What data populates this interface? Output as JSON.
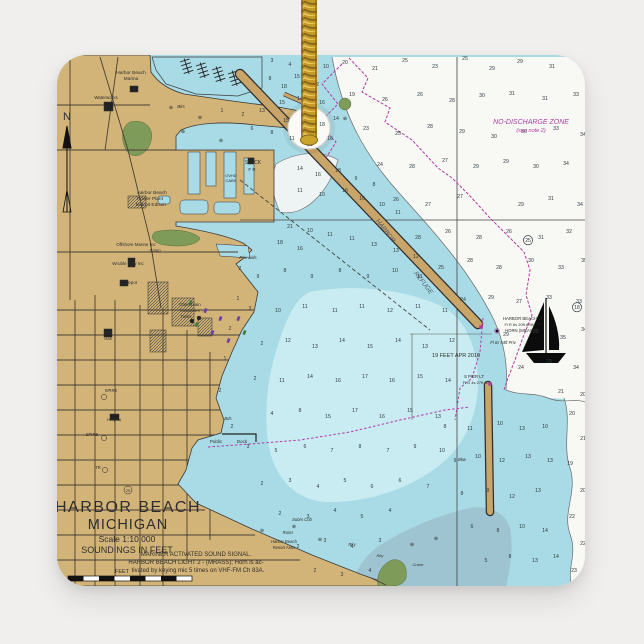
{
  "product": {
    "type": "square ceramic holiday ornament with gold hanging cord",
    "background_color": "#f0efed",
    "cord": {
      "gold_mid": "#c79a2a",
      "gold_light": "#e9c95c",
      "gold_dark": "#8a6a1a"
    }
  },
  "palette": {
    "bg": "#f0efed",
    "land": "#d3b478",
    "water": "#a9dbe6",
    "water_light": "#c9ecf2",
    "water_deep": "#f8f8f4",
    "water_gray": "#9cc0cc",
    "green": "#7e9b5a",
    "breakwater": "#c9a569",
    "magenta": "#b13ba5",
    "ink": "#2e2e2e",
    "street": "#473f33"
  },
  "chart": {
    "title": "HARBOR BEACH MICHIGAN nautical chart",
    "labels": [
      {
        "t": "HARBOR  BEACH",
        "x": 128,
        "y": 512,
        "s": 16,
        "ls": 1.5
      },
      {
        "t": "MICHIGAN",
        "x": 128,
        "y": 529,
        "s": 14.5,
        "ls": 1
      },
      {
        "t": "Scale 1:10,000",
        "x": 127,
        "y": 542,
        "s": 8.5
      },
      {
        "t": "SOUNDINGS IN FEET",
        "x": 127,
        "y": 553,
        "s": 9
      },
      {
        "t": "MARINER ACTIVATED SOUND SIGNAL.",
        "x": 196,
        "y": 556,
        "s": 6
      },
      {
        "t": "HARBOR BEACH LIGHT 2 - (MRASS); Horn is ac-",
        "x": 196,
        "y": 564,
        "s": 6
      },
      {
        "t": "tivated by keying mic 5 times on VHF-FM Ch 83A.",
        "x": 198,
        "y": 572,
        "s": 6
      },
      {
        "t": "FEET",
        "x": 122,
        "y": 573,
        "s": 5.5
      },
      {
        "t": "N",
        "x": 67,
        "y": 120,
        "s": 11
      },
      {
        "t": "Harbor Beach",
        "x": 131,
        "y": 74,
        "s": 4.8
      },
      {
        "t": "Marina",
        "x": 131,
        "y": 80,
        "s": 4.8
      },
      {
        "t": "Waterworks",
        "x": 106,
        "y": 99,
        "s": 4.5
      },
      {
        "t": "Bks",
        "x": 181,
        "y": 108,
        "s": 4.5,
        "i": true
      },
      {
        "t": "Harbor Beach",
        "x": 152,
        "y": 194,
        "s": 4.8
      },
      {
        "t": "Power Plant",
        "x": 150,
        "y": 200,
        "s": 4.8
      },
      {
        "t": "Detroit Edison",
        "x": 151,
        "y": 206,
        "s": 4.8
      },
      {
        "t": "Offshore Marine Inc",
        "x": 136,
        "y": 246,
        "s": 4.5
      },
      {
        "t": "Ramp",
        "x": 155,
        "y": 252,
        "s": 4.2,
        "i": true
      },
      {
        "t": "Wruble Elev Inc",
        "x": 128,
        "y": 265,
        "s": 4.5
      },
      {
        "t": "Depot",
        "x": 131,
        "y": 284,
        "s": 4.5
      },
      {
        "t": "Champlain",
        "x": 190,
        "y": 306,
        "s": 4.5
      },
      {
        "t": "Industries",
        "x": 190,
        "y": 312,
        "s": 4.5
      },
      {
        "t": "Tanks",
        "x": 186,
        "y": 318,
        "s": 4.2
      },
      {
        "t": "City",
        "x": 108,
        "y": 334,
        "s": 4.2
      },
      {
        "t": "Hall",
        "x": 108,
        "y": 340,
        "s": 4.2
      },
      {
        "t": "Hospital",
        "x": 114,
        "y": 421,
        "s": 4
      },
      {
        "t": "SPIRE",
        "x": 111,
        "y": 392,
        "s": 4.2
      },
      {
        "t": "SPIRE",
        "x": 92,
        "y": 436,
        "s": 4.2
      },
      {
        "t": "TR",
        "x": 98,
        "y": 469,
        "s": 4.2
      },
      {
        "t": "25",
        "x": 128,
        "y": 492,
        "s": 4
      },
      {
        "t": "STACK",
        "x": 253,
        "y": 164,
        "s": 5
      },
      {
        "t": "F R",
        "x": 252,
        "y": 171,
        "s": 4.5
      },
      {
        "t": "OVHD",
        "x": 231,
        "y": 177,
        "s": 4
      },
      {
        "t": "CABS",
        "x": 231,
        "y": 182,
        "s": 4
      },
      {
        "t": "Priv aids",
        "x": 248,
        "y": 259,
        "s": 4.5,
        "i": true
      },
      {
        "t": "Public",
        "x": 216,
        "y": 443,
        "s": 4.5
      },
      {
        "t": "Dock",
        "x": 242,
        "y": 443,
        "s": 4.5
      },
      {
        "t": "Bds",
        "x": 228,
        "y": 420,
        "s": 4.2,
        "i": true
      },
      {
        "t": "Bkw",
        "x": 462,
        "y": 461,
        "s": 4.2,
        "i": true
      },
      {
        "t": "HARBOR",
        "x": 384,
        "y": 232,
        "s": 6.5,
        "r": 52,
        "i": true,
        "c": "#4a5a66"
      },
      {
        "t": "REFUGE",
        "x": 422,
        "y": 284,
        "s": 6.5,
        "r": 52,
        "i": true,
        "c": "#4a5a66"
      },
      {
        "t": "NO-DISCHARGE ZONE",
        "x": 531,
        "y": 124,
        "s": 7,
        "i": true,
        "c": "#b13ba5"
      },
      {
        "t": "(see note 2)",
        "x": 531,
        "y": 132,
        "s": 5.5,
        "i": true,
        "c": "#b13ba5"
      },
      {
        "t": "19 FEET APR 2016",
        "x": 456,
        "y": 357,
        "s": 5.5
      },
      {
        "t": "HARBOR BEACH LT",
        "x": 523,
        "y": 320,
        "s": 4.3
      },
      {
        "t": "Fl R 6s 20ft 8StM \"2\"",
        "x": 523,
        "y": 326,
        "s": 4
      },
      {
        "t": "HORN (MRASS)",
        "x": 521,
        "y": 332,
        "s": 4.3
      },
      {
        "t": "Fl 6s 54ft Priv",
        "x": 503,
        "y": 344,
        "s": 4.2,
        "i": true
      },
      {
        "t": "S PIER LT",
        "x": 474,
        "y": 378,
        "s": 4.3
      },
      {
        "t": "Fl G 4s 27ft \"1\"",
        "x": 476,
        "y": 384,
        "s": 4
      },
      {
        "t": "Harbor Beach",
        "x": 284,
        "y": 543,
        "s": 4.2
      },
      {
        "t": "Resort Assn",
        "x": 284,
        "y": 549,
        "s": 4.2
      },
      {
        "t": "Subm Crib",
        "x": 302,
        "y": 521,
        "s": 4.2,
        "i": true
      },
      {
        "t": "Ruins",
        "x": 288,
        "y": 534,
        "s": 4.2,
        "i": true
      },
      {
        "t": "Rky",
        "x": 352,
        "y": 546,
        "s": 4.2,
        "i": true
      },
      {
        "t": "Rky",
        "x": 380,
        "y": 557,
        "s": 4,
        "i": true
      },
      {
        "t": "Crane",
        "x": 418,
        "y": 566,
        "s": 4,
        "i": true
      }
    ],
    "soundings": [
      [
        345,
        64,
        "20"
      ],
      [
        375,
        70,
        "21"
      ],
      [
        405,
        62,
        "25"
      ],
      [
        435,
        68,
        "23"
      ],
      [
        465,
        60,
        "25"
      ],
      [
        492,
        70,
        "29"
      ],
      [
        520,
        63,
        "29"
      ],
      [
        552,
        68,
        "31"
      ],
      [
        580,
        62,
        "30"
      ],
      [
        352,
        96,
        "19"
      ],
      [
        385,
        101,
        "26"
      ],
      [
        420,
        96,
        "26"
      ],
      [
        452,
        102,
        "28"
      ],
      [
        482,
        97,
        "30"
      ],
      [
        512,
        95,
        "31"
      ],
      [
        545,
        100,
        "31"
      ],
      [
        576,
        96,
        "33"
      ],
      [
        366,
        130,
        "23"
      ],
      [
        398,
        135,
        "25"
      ],
      [
        430,
        128,
        "28"
      ],
      [
        462,
        133,
        "29"
      ],
      [
        494,
        138,
        "30"
      ],
      [
        524,
        133,
        "30"
      ],
      [
        556,
        130,
        "33"
      ],
      [
        583,
        136,
        "34"
      ],
      [
        380,
        166,
        "24"
      ],
      [
        412,
        168,
        "28"
      ],
      [
        445,
        162,
        "27"
      ],
      [
        476,
        168,
        "29"
      ],
      [
        506,
        163,
        "29"
      ],
      [
        536,
        168,
        "30"
      ],
      [
        566,
        165,
        "34"
      ],
      [
        396,
        201,
        "26"
      ],
      [
        428,
        206,
        "27"
      ],
      [
        460,
        198,
        "27"
      ],
      [
        521,
        206,
        "29"
      ],
      [
        551,
        200,
        "31"
      ],
      [
        580,
        206,
        "34"
      ],
      [
        418,
        239,
        "28"
      ],
      [
        448,
        233,
        "26"
      ],
      [
        479,
        239,
        "28"
      ],
      [
        509,
        233,
        "26"
      ],
      [
        541,
        239,
        "31"
      ],
      [
        569,
        233,
        "32"
      ],
      [
        441,
        269,
        "25"
      ],
      [
        470,
        262,
        "28"
      ],
      [
        499,
        269,
        "28"
      ],
      [
        531,
        262,
        "30"
      ],
      [
        561,
        269,
        "33"
      ],
      [
        584,
        262,
        "35"
      ],
      [
        463,
        301,
        "24"
      ],
      [
        491,
        299,
        "29"
      ],
      [
        519,
        303,
        "27"
      ],
      [
        549,
        299,
        "33"
      ],
      [
        579,
        303,
        "33"
      ],
      [
        506,
        336,
        "29"
      ],
      [
        536,
        333,
        "29"
      ],
      [
        563,
        339,
        "35"
      ],
      [
        584,
        331,
        "34"
      ],
      [
        521,
        369,
        "24"
      ],
      [
        549,
        363,
        "29"
      ],
      [
        576,
        369,
        "34"
      ],
      [
        561,
        393,
        "21"
      ],
      [
        583,
        396,
        "20"
      ],
      [
        272,
        62,
        "3"
      ],
      [
        290,
        66,
        "4"
      ],
      [
        310,
        60,
        "9"
      ],
      [
        326,
        68,
        "10"
      ],
      [
        297,
        78,
        "15"
      ],
      [
        316,
        86,
        "12"
      ],
      [
        284,
        88,
        "18"
      ],
      [
        270,
        80,
        "8"
      ],
      [
        282,
        104,
        "15"
      ],
      [
        300,
        100,
        "14"
      ],
      [
        322,
        104,
        "16"
      ],
      [
        262,
        112,
        "13"
      ],
      [
        243,
        116,
        "2"
      ],
      [
        222,
        112,
        "1"
      ],
      [
        286,
        122,
        "15"
      ],
      [
        305,
        118,
        "15"
      ],
      [
        322,
        126,
        "18"
      ],
      [
        336,
        120,
        "14"
      ],
      [
        330,
        140,
        "16"
      ],
      [
        310,
        146,
        "21"
      ],
      [
        292,
        140,
        "11"
      ],
      [
        272,
        134,
        "8"
      ],
      [
        252,
        130,
        "6"
      ],
      [
        300,
        170,
        "14"
      ],
      [
        318,
        176,
        "16"
      ],
      [
        338,
        172,
        "18"
      ],
      [
        356,
        180,
        "9"
      ],
      [
        374,
        186,
        "8"
      ],
      [
        345,
        192,
        "16"
      ],
      [
        322,
        196,
        "10"
      ],
      [
        300,
        192,
        "11"
      ],
      [
        362,
        200,
        "16"
      ],
      [
        382,
        206,
        "10"
      ],
      [
        398,
        214,
        "11"
      ],
      [
        290,
        228,
        "21"
      ],
      [
        310,
        232,
        "10"
      ],
      [
        330,
        236,
        "11"
      ],
      [
        352,
        240,
        "11"
      ],
      [
        374,
        246,
        "13"
      ],
      [
        396,
        252,
        "13"
      ],
      [
        416,
        258,
        "12"
      ],
      [
        300,
        250,
        "16"
      ],
      [
        280,
        244,
        "18"
      ],
      [
        258,
        278,
        "9"
      ],
      [
        285,
        272,
        "8"
      ],
      [
        312,
        278,
        "9"
      ],
      [
        340,
        272,
        "8"
      ],
      [
        368,
        278,
        "9"
      ],
      [
        395,
        272,
        "10"
      ],
      [
        420,
        278,
        "11"
      ],
      [
        250,
        310,
        "3"
      ],
      [
        278,
        312,
        "10"
      ],
      [
        305,
        308,
        "11"
      ],
      [
        335,
        312,
        "11"
      ],
      [
        362,
        308,
        "11"
      ],
      [
        390,
        312,
        "12"
      ],
      [
        418,
        308,
        "11"
      ],
      [
        445,
        312,
        "11"
      ],
      [
        262,
        345,
        "2"
      ],
      [
        288,
        342,
        "12"
      ],
      [
        315,
        348,
        "13"
      ],
      [
        342,
        342,
        "14"
      ],
      [
        370,
        348,
        "15"
      ],
      [
        398,
        342,
        "14"
      ],
      [
        425,
        348,
        "13"
      ],
      [
        452,
        342,
        "12"
      ],
      [
        255,
        380,
        "2"
      ],
      [
        282,
        382,
        "11"
      ],
      [
        310,
        378,
        "14"
      ],
      [
        338,
        382,
        "16"
      ],
      [
        365,
        378,
        "17"
      ],
      [
        392,
        382,
        "16"
      ],
      [
        420,
        378,
        "15"
      ],
      [
        448,
        382,
        "14"
      ],
      [
        272,
        415,
        "4"
      ],
      [
        300,
        412,
        "8"
      ],
      [
        328,
        418,
        "15"
      ],
      [
        355,
        412,
        "17"
      ],
      [
        382,
        418,
        "16"
      ],
      [
        410,
        412,
        "15"
      ],
      [
        438,
        418,
        "13"
      ],
      [
        248,
        448,
        "3"
      ],
      [
        276,
        452,
        "5"
      ],
      [
        305,
        448,
        "6"
      ],
      [
        332,
        452,
        "7"
      ],
      [
        360,
        448,
        "8"
      ],
      [
        388,
        452,
        "7"
      ],
      [
        415,
        448,
        "9"
      ],
      [
        442,
        452,
        "10"
      ],
      [
        262,
        485,
        "2"
      ],
      [
        290,
        482,
        "3"
      ],
      [
        318,
        488,
        "4"
      ],
      [
        345,
        482,
        "5"
      ],
      [
        372,
        488,
        "6"
      ],
      [
        400,
        482,
        "6"
      ],
      [
        428,
        488,
        "7"
      ],
      [
        280,
        515,
        "2"
      ],
      [
        308,
        518,
        "3"
      ],
      [
        335,
        512,
        "4"
      ],
      [
        362,
        518,
        "5"
      ],
      [
        390,
        512,
        "4"
      ],
      [
        298,
        548,
        "2"
      ],
      [
        325,
        542,
        "3"
      ],
      [
        352,
        548,
        "4"
      ],
      [
        380,
        542,
        "3"
      ],
      [
        315,
        572,
        "2"
      ],
      [
        342,
        576,
        "3"
      ],
      [
        370,
        572,
        "4"
      ],
      [
        470,
        430,
        "11"
      ],
      [
        445,
        428,
        "8"
      ],
      [
        500,
        425,
        "10"
      ],
      [
        522,
        430,
        "13"
      ],
      [
        545,
        428,
        "10"
      ],
      [
        455,
        462,
        "9"
      ],
      [
        478,
        458,
        "10"
      ],
      [
        502,
        462,
        "12"
      ],
      [
        528,
        458,
        "13"
      ],
      [
        550,
        462,
        "13"
      ],
      [
        462,
        495,
        "8"
      ],
      [
        488,
        492,
        "9"
      ],
      [
        512,
        498,
        "12"
      ],
      [
        538,
        492,
        "13"
      ],
      [
        472,
        528,
        "6"
      ],
      [
        498,
        532,
        "8"
      ],
      [
        522,
        528,
        "10"
      ],
      [
        545,
        532,
        "14"
      ],
      [
        486,
        562,
        "5"
      ],
      [
        510,
        558,
        "8"
      ],
      [
        535,
        562,
        "13"
      ],
      [
        556,
        558,
        "14"
      ],
      [
        572,
        415,
        "20"
      ],
      [
        583,
        440,
        "21"
      ],
      [
        570,
        465,
        "19"
      ],
      [
        583,
        492,
        "20"
      ],
      [
        572,
        518,
        "22"
      ],
      [
        583,
        545,
        "22"
      ],
      [
        574,
        572,
        "23"
      ],
      [
        240,
        270,
        "2"
      ],
      [
        238,
        300,
        "1"
      ],
      [
        230,
        330,
        "2"
      ],
      [
        225,
        360,
        "1"
      ],
      [
        220,
        392,
        "2"
      ],
      [
        232,
        428,
        "2"
      ]
    ],
    "circled_soundings": [
      [
        577,
        309,
        "18"
      ],
      [
        528,
        242,
        "25"
      ]
    ],
    "rock_symbols": [
      [
        171,
        109
      ],
      [
        200,
        119
      ],
      [
        183,
        133
      ],
      [
        221,
        142
      ],
      [
        262,
        532
      ],
      [
        294,
        528
      ],
      [
        320,
        541
      ],
      [
        412,
        546
      ],
      [
        436,
        540
      ],
      [
        345,
        120
      ]
    ],
    "mooring_symbols": [
      [
        190,
        300
      ],
      [
        205,
        308
      ],
      [
        220,
        316
      ],
      [
        196,
        322
      ],
      [
        212,
        330
      ],
      [
        228,
        338
      ],
      [
        244,
        330
      ],
      [
        238,
        316
      ]
    ]
  }
}
